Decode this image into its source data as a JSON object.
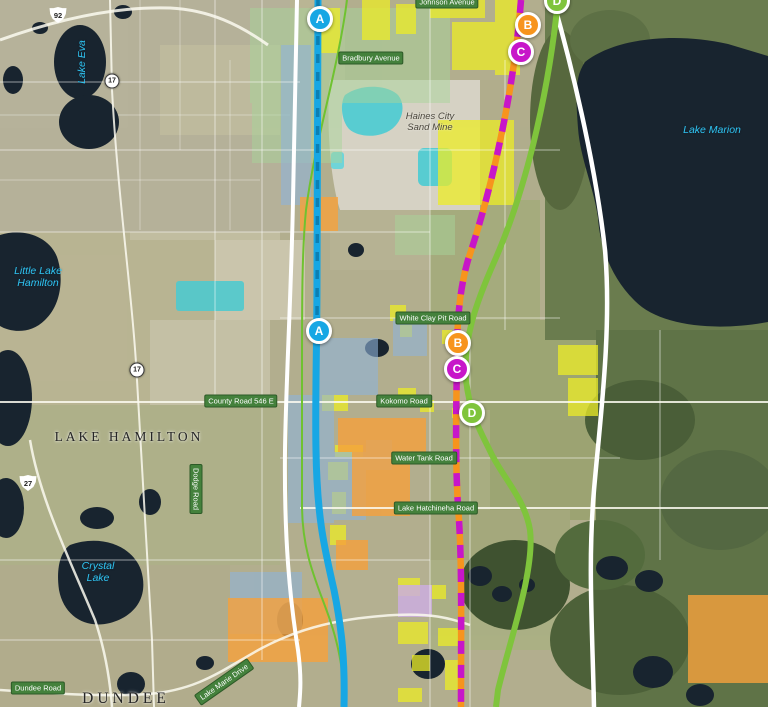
{
  "map": {
    "towns": [
      {
        "name": "LAKE HAMILTON"
      },
      {
        "name": "DUNDEE"
      }
    ],
    "lakes": [
      {
        "name": "Lake Eva"
      },
      {
        "name": "Little Lake Hamilton"
      },
      {
        "name": "Crystal Lake"
      },
      {
        "name": "Lake Marion"
      }
    ],
    "poi": [
      {
        "name": "Haines City Sand Mine"
      }
    ],
    "roads": [
      {
        "name": "Johnson Avenue"
      },
      {
        "name": "Bradbury Avenue"
      },
      {
        "name": "White Clay Pit Road"
      },
      {
        "name": "County Road 546 E"
      },
      {
        "name": "Kokomo Road"
      },
      {
        "name": "Water Tank Road"
      },
      {
        "name": "Lake Hatchineha Road"
      },
      {
        "name": "Dodge Road"
      },
      {
        "name": "Dundee Road"
      },
      {
        "name": "Lake Marie Drive"
      }
    ],
    "shields": [
      {
        "route": "92",
        "type": "us-highway"
      },
      {
        "route": "17",
        "type": "state-road"
      },
      {
        "route": "17",
        "type": "state-road"
      },
      {
        "route": "27",
        "type": "us-highway"
      }
    ],
    "alternatives": {
      "a": {
        "label": "A",
        "color": "#17a7e4",
        "style": "solid"
      },
      "b": {
        "label": "B",
        "color": "#f7941d",
        "style": "dashed"
      },
      "c": {
        "label": "C",
        "color": "#c716c9",
        "style": "dashed"
      },
      "d": {
        "label": "D",
        "color": "#7fc43c",
        "style": "solid"
      }
    },
    "markers": [
      {
        "label": "A"
      },
      {
        "label": "B"
      },
      {
        "label": "C"
      },
      {
        "label": "D"
      },
      {
        "label": "A"
      },
      {
        "label": "B"
      },
      {
        "label": "C"
      },
      {
        "label": "D"
      }
    ]
  }
}
